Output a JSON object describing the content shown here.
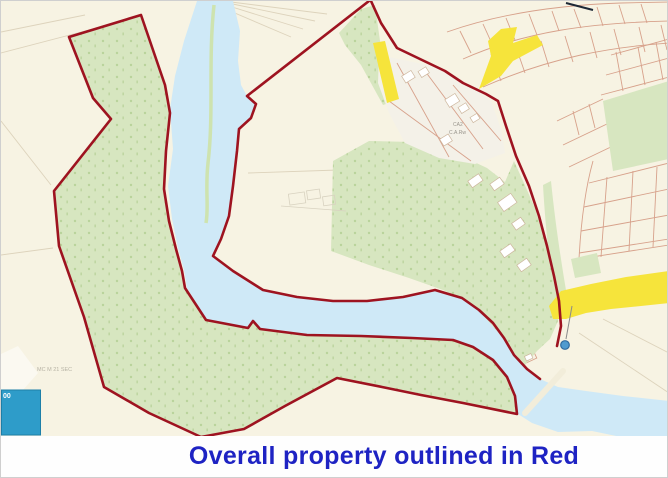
{
  "window": {
    "width": 668,
    "height": 478
  },
  "caption": {
    "text": "Overall property outlined in Red"
  },
  "map": {
    "labels": {
      "farm_area_line1": "CA2",
      "farm_area_line2": "C.A.Rw",
      "field_label": "MC M 21 SEC",
      "scale_box": "00"
    },
    "icons": {
      "location_marker": "blue-circle-map-marker-icon",
      "scale_box": "blue-square-legend-swatch"
    }
  },
  "colors": {
    "boundary_red": "#9e1320",
    "river_blue": "#cfe9f7",
    "woodland_green": "#d7e6c0",
    "tree_green": "#b9d39b",
    "land_cream": "#f7f3e3",
    "farm_white": "#f4f1e8",
    "road_yellow": "#f6e43b",
    "parcel_tan": "#d7a18b",
    "caption_blue": "#1e23c3",
    "legend_blue": "#2e9cc9",
    "marker_blue": "#4f9bcf",
    "waterline_green": "#cde2a6"
  }
}
